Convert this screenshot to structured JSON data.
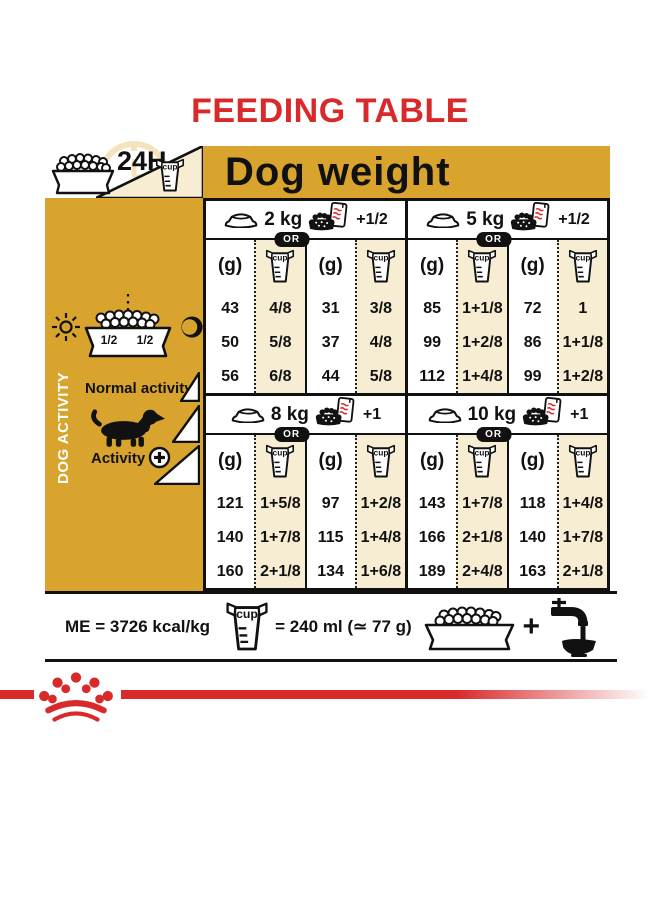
{
  "title": "FEEDING TABLE",
  "colors": {
    "red": "#D8292B",
    "gold": "#D8A42D",
    "cream": "#F7EDD2"
  },
  "header": {
    "daily": "24H",
    "dog_weight": "Dog weight"
  },
  "cup_text": "cup",
  "sidebar": {
    "vertical_label": "DOG ACTIVITY",
    "half_left": "1/2",
    "half_right": "1/2",
    "normal_activity": "Normal activity",
    "activity": "Activity",
    "activity_plus": "+"
  },
  "table": {
    "grams_header": "(g)",
    "or_label": "OR",
    "sections": [
      {
        "weight": "2 kg",
        "extra": "+1/2",
        "dry_g": [
          "43",
          "50",
          "56"
        ],
        "dry_cup": [
          "4/8",
          "5/8",
          "6/8"
        ],
        "mix_g": [
          "31",
          "37",
          "44"
        ],
        "mix_cup": [
          "3/8",
          "4/8",
          "5/8"
        ]
      },
      {
        "weight": "5 kg",
        "extra": "+1/2",
        "dry_g": [
          "85",
          "99",
          "112"
        ],
        "dry_cup": [
          "1+1/8",
          "1+2/8",
          "1+4/8"
        ],
        "mix_g": [
          "72",
          "86",
          "99"
        ],
        "mix_cup": [
          "1",
          "1+1/8",
          "1+2/8"
        ]
      },
      {
        "weight": "8 kg",
        "extra": "+1",
        "dry_g": [
          "121",
          "140",
          "160"
        ],
        "dry_cup": [
          "1+5/8",
          "1+7/8",
          "2+1/8"
        ],
        "mix_g": [
          "97",
          "115",
          "134"
        ],
        "mix_cup": [
          "1+2/8",
          "1+4/8",
          "1+6/8"
        ]
      },
      {
        "weight": "10 kg",
        "extra": "+1",
        "dry_g": [
          "143",
          "166",
          "189"
        ],
        "dry_cup": [
          "1+7/8",
          "2+1/8",
          "2+4/8"
        ],
        "mix_g": [
          "118",
          "140",
          "163"
        ],
        "mix_cup": [
          "1+4/8",
          "1+7/8",
          "2+1/8"
        ]
      }
    ]
  },
  "legend": {
    "me": "ME = 3726 kcal/kg",
    "equiv": "= 240 ml (≃ 77 g)",
    "plus": "+"
  }
}
